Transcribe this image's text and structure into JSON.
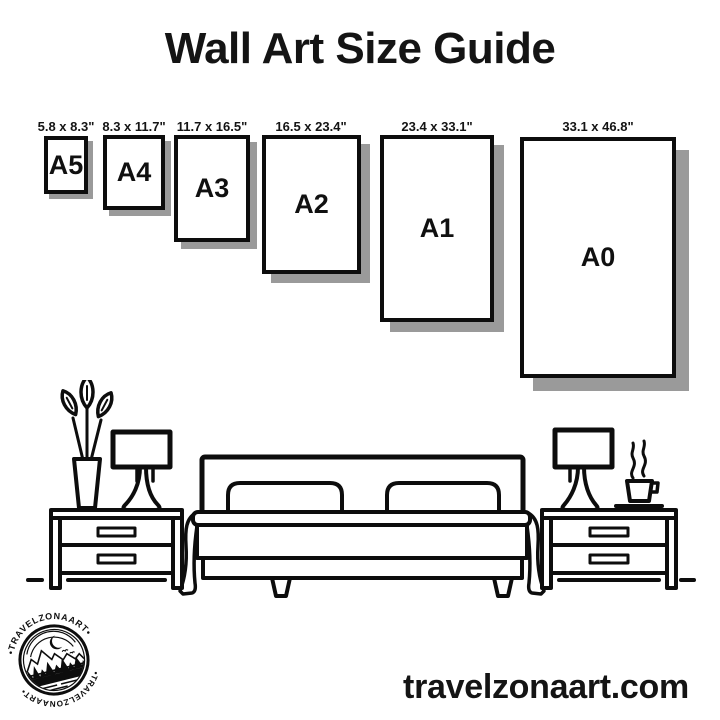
{
  "title": "Wall Art Size Guide",
  "sizes": [
    {
      "label": "A5",
      "dimensions": "5.8 x 8.3\""
    },
    {
      "label": "A4",
      "dimensions": "8.3 x 11.7\""
    },
    {
      "label": "A3",
      "dimensions": "11.7 x 16.5\""
    },
    {
      "label": "A2",
      "dimensions": "16.5 x 23.4\""
    },
    {
      "label": "A1",
      "dimensions": "23.4 x 33.1\""
    },
    {
      "label": "A0",
      "dimensions": "33.1 x 46.8\""
    }
  ],
  "badge": {
    "text_top": "•TRAVELZONAART•",
    "text_bottom": "•TRAVELZONAART•"
  },
  "footer": {
    "website": "travelzonaart.com"
  },
  "illustration_icons": [
    "plant-vase-icon",
    "table-lamp-icon",
    "nightstand-icon",
    "double-bed-icon",
    "pillow-icon",
    "coffee-cup-icon",
    "floor-line-icon"
  ],
  "colors": {
    "ink": "#0d0d0d",
    "text": "#141414",
    "shadow": "#9a9a9a",
    "background": "#ffffff"
  }
}
